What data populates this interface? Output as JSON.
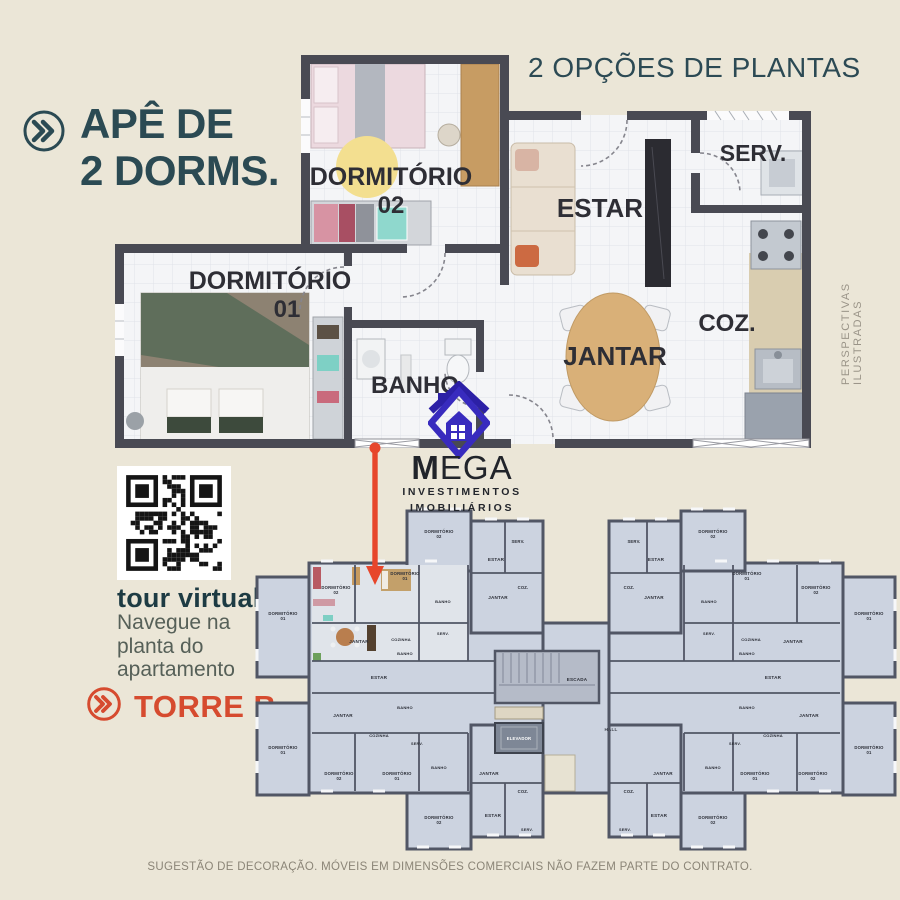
{
  "title": {
    "line1": "APÊ DE",
    "line2": "2 DORMS."
  },
  "subtitle": "2 OPÇÕES DE PLANTAS",
  "side_note": "PERSPECTIVAS ILUSTRADAS",
  "unit_plan": {
    "rooms": {
      "dorm02": {
        "name": "DORMITÓRIO",
        "number": "02"
      },
      "dorm01": {
        "name": "DORMITÓRIO",
        "number": "01"
      },
      "estar": "ESTAR",
      "serv": "SERV.",
      "coz": "COZ.",
      "jantar": "JANTAR",
      "banho": "BANHO"
    }
  },
  "brand": {
    "name": "MEGA",
    "tagline1": "INVESTIMENTOS",
    "tagline2": "IMOBILIÁRIOS"
  },
  "tour": {
    "title": "tour virtual",
    "caption": [
      "Navegue na",
      "planta do",
      "apartamento"
    ]
  },
  "tower": {
    "label": "TORRE B"
  },
  "floor_plate": {
    "core": {
      "stairs": "ESCADA",
      "elevator": "ELEVADOR",
      "hall": "HALL"
    },
    "labels": [
      {
        "x": 184,
        "y": 30,
        "t": "DORMITÓRIO",
        "s": "02",
        "fs": 4.2
      },
      {
        "x": 263,
        "y": 40,
        "t": "SERV.",
        "fs": 4.2
      },
      {
        "x": 241,
        "y": 58,
        "t": "ESTAR",
        "fs": 4.6
      },
      {
        "x": 268,
        "y": 86,
        "t": "COZ.",
        "fs": 4.2
      },
      {
        "x": 243,
        "y": 96,
        "t": "JANTAR",
        "fs": 4.6
      },
      {
        "x": 150,
        "y": 72,
        "t": "DORMITÓRIO",
        "s": "01",
        "fs": 4.2
      },
      {
        "x": 81,
        "y": 86,
        "t": "DORMITÓRIO",
        "s": "02",
        "fs": 4.2
      },
      {
        "x": 188,
        "y": 100,
        "t": "BANHO",
        "fs": 4.0
      },
      {
        "x": 28,
        "y": 112,
        "t": "DORMITÓRIO",
        "s": "01",
        "fs": 4.2
      },
      {
        "x": 104,
        "y": 140,
        "t": "JANTAR",
        "fs": 4.6
      },
      {
        "x": 146,
        "y": 138,
        "t": "COZINHA",
        "fs": 4.0
      },
      {
        "x": 188,
        "y": 132,
        "t": "SERV.",
        "fs": 3.8
      },
      {
        "x": 124,
        "y": 176,
        "t": "ESTAR",
        "fs": 4.6
      },
      {
        "x": 150,
        "y": 152,
        "t": "BANHO",
        "fs": 4.0
      },
      {
        "x": 150,
        "y": 206,
        "t": "BANHO",
        "fs": 4.0
      },
      {
        "x": 88,
        "y": 214,
        "t": "JANTAR",
        "fs": 4.6
      },
      {
        "x": 124,
        "y": 234,
        "t": "COZINHA",
        "fs": 4.0
      },
      {
        "x": 162,
        "y": 242,
        "t": "SERV.",
        "fs": 3.8
      },
      {
        "x": 28,
        "y": 246,
        "t": "DORMITÓRIO",
        "s": "01",
        "fs": 4.2
      },
      {
        "x": 84,
        "y": 272,
        "t": "DORMITÓRIO",
        "s": "02",
        "fs": 4.2
      },
      {
        "x": 142,
        "y": 272,
        "t": "DORMITÓRIO",
        "s": "01",
        "fs": 4.2
      },
      {
        "x": 184,
        "y": 266,
        "t": "BANHO",
        "fs": 4.0
      },
      {
        "x": 234,
        "y": 272,
        "t": "JANTAR",
        "fs": 4.6
      },
      {
        "x": 268,
        "y": 290,
        "t": "COZ.",
        "fs": 4.2
      },
      {
        "x": 238,
        "y": 314,
        "t": "ESTAR",
        "fs": 4.6
      },
      {
        "x": 272,
        "y": 328,
        "t": "SERV.",
        "fs": 3.8
      },
      {
        "x": 184,
        "y": 316,
        "t": "DORMITÓRIO",
        "s": "02",
        "fs": 4.2
      }
    ]
  },
  "footer": "SUGESTÃO DE DECORAÇÃO. MÓVEIS EM DIMENSÕES COMERCIAIS NÃO FAZEM PARTE DO CONTRATO.",
  "colors": {
    "teal": "#2b4a53",
    "accent": "#d64b2f",
    "arrow": "#e7462b",
    "brand_purple": "#382bbe",
    "tour_icon": "#dd8b3c"
  }
}
